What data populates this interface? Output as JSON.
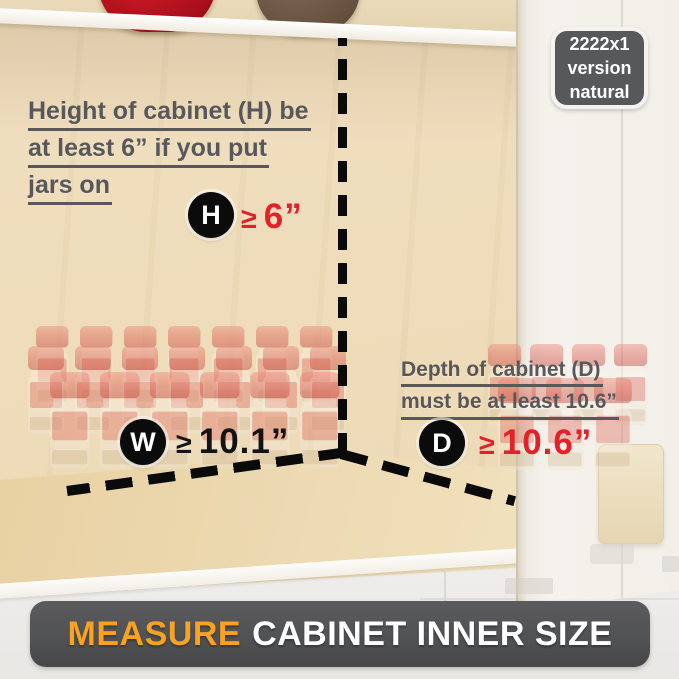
{
  "badge": {
    "lines": [
      "2222x1",
      "version",
      "natural"
    ]
  },
  "notes": {
    "height": {
      "line1": "Height of cabinet (H) be",
      "line2": "at least 6” if you put",
      "line3": "jars on"
    },
    "depth": {
      "line1": "Depth of cabinet (D)",
      "line2": "must be at least 10.6”"
    }
  },
  "markers": {
    "height": {
      "letter": "H",
      "symbol": "≥",
      "value": "6”"
    },
    "width": {
      "letter": "W",
      "symbol": "≥",
      "value": "10.1”"
    },
    "depth": {
      "letter": "D",
      "symbol": "≥",
      "value": "10.6”"
    }
  },
  "banner": {
    "highlight": "MEASURE",
    "rest": "CABINET INNER SIZE"
  },
  "colors": {
    "accent_red": "#e32128",
    "accent_orange": "#f7a222",
    "note_gray": "#58585a",
    "marker_black": "#0b0b0b",
    "banner_bg": "#515254",
    "badge_bg": "#57585a"
  }
}
